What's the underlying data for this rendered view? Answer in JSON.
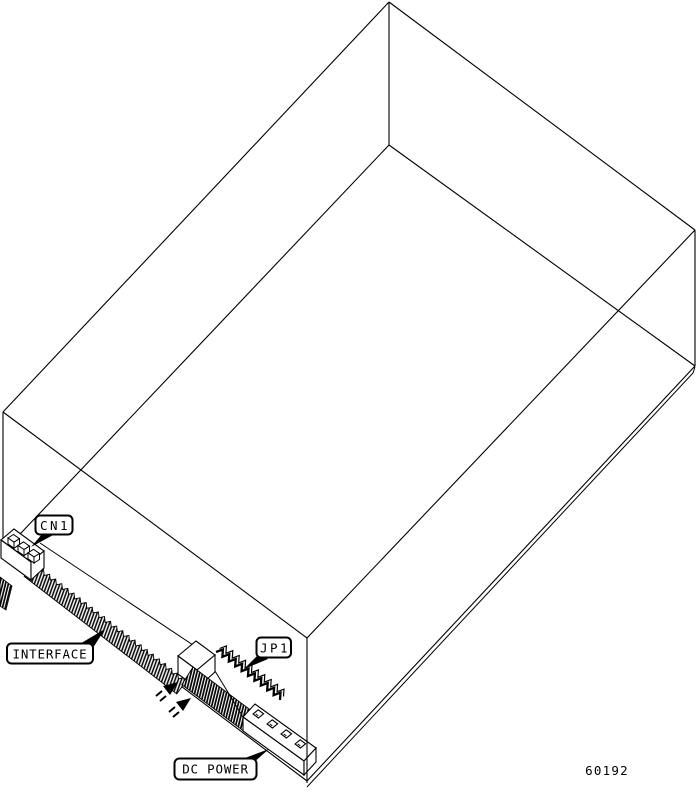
{
  "figure": {
    "background_color": "#ffffff",
    "line_color": "#000000",
    "part_number": "60192",
    "callouts": [
      {
        "id": "cn1",
        "label": "CN1"
      },
      {
        "id": "interface",
        "label": "INTERFACE"
      },
      {
        "id": "jp1",
        "label": "JP1"
      },
      {
        "id": "dc_power",
        "label": "DC POWER"
      }
    ]
  }
}
